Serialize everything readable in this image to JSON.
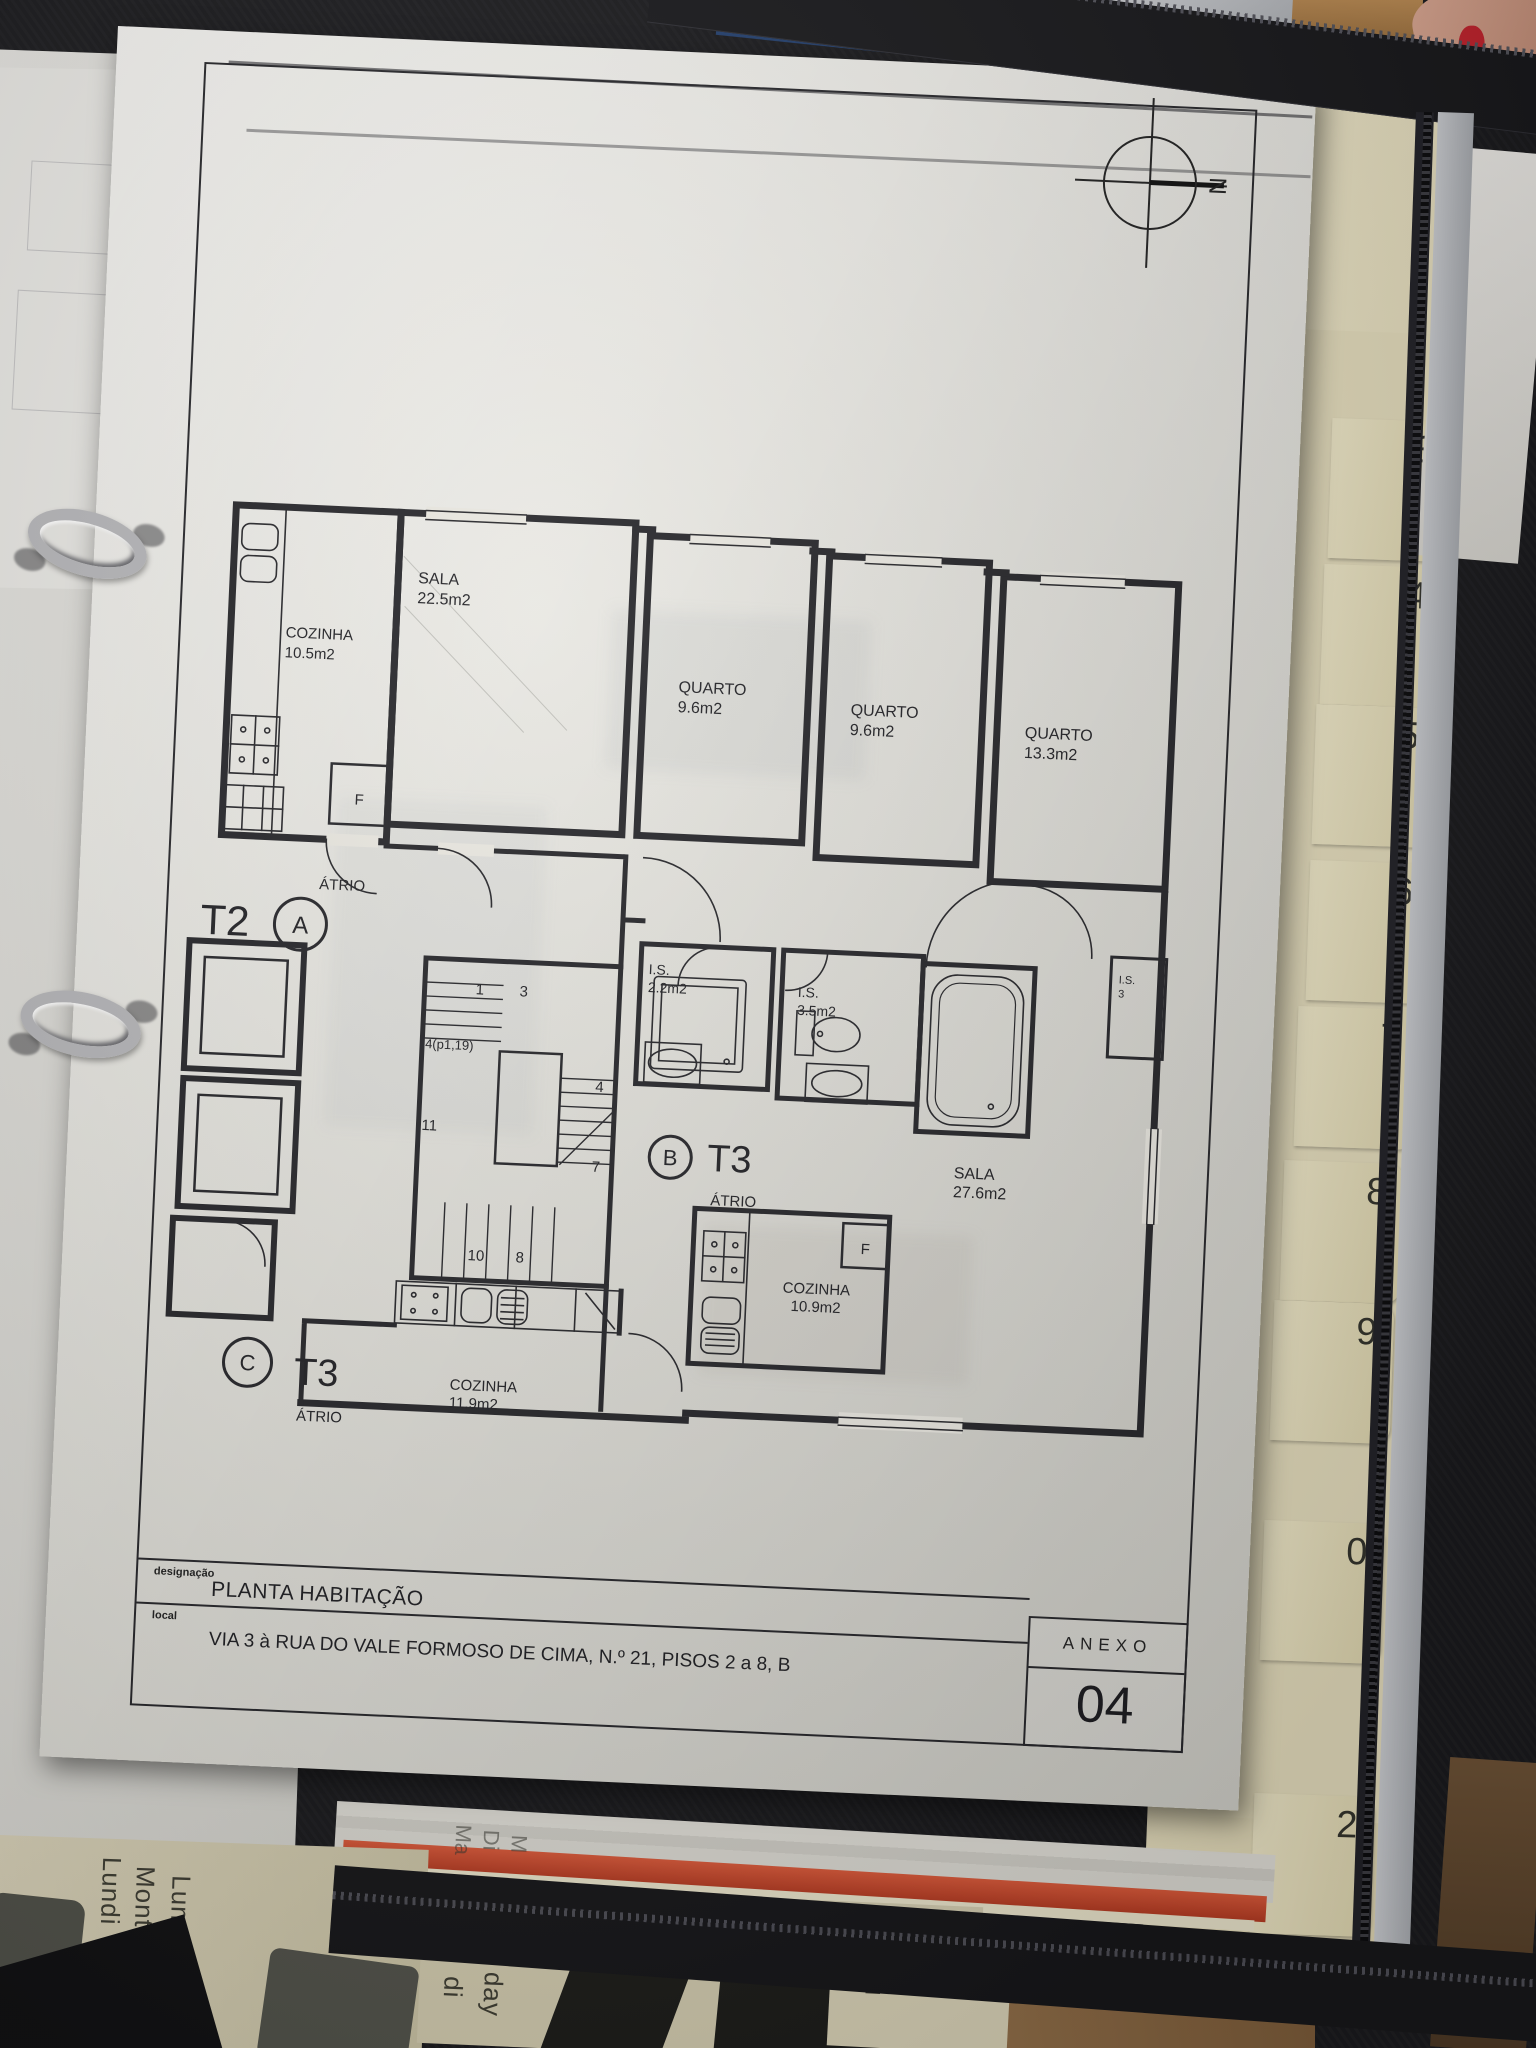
{
  "photo": {
    "tabs": [
      "3",
      "4",
      "5",
      "6",
      "7",
      "8",
      "9",
      "0",
      "2"
    ],
    "books": {
      "left": [
        "Lundi",
        "Montag",
        "Lunes"
      ],
      "mid_top": [
        "Ma",
        "Di",
        "M"
      ],
      "mid_bottom": [
        "di",
        "day"
      ],
      "right": [
        "rcoled",
        "dnes"
      ]
    }
  },
  "sheet": {
    "compass": {
      "north": "N"
    },
    "plan": {
      "f": "F",
      "rooms": {
        "sala_t2": {
          "name": "SALA",
          "area": "22.5m2"
        },
        "quarto_1": {
          "name": "QUARTO",
          "area": "9.6m2"
        },
        "quarto_2": {
          "name": "QUARTO",
          "area": "9.6m2"
        },
        "quarto_3": {
          "name": "QUARTO",
          "area": "13.3m2"
        },
        "cozinha_t2": {
          "name": "COZINHA",
          "area": "10.5m2"
        },
        "is_1": {
          "name": "I.S.",
          "area": "2.2m2"
        },
        "is_2": {
          "name": "I.S.",
          "area": "3.5m2"
        },
        "is_small": {
          "name": "I.S.",
          "area": "3"
        },
        "sala_t3": {
          "name": "SALA",
          "area": "27.6m2"
        },
        "cozinha_t3b": {
          "name": "COZINHA",
          "area": "10.9m2"
        },
        "cozinha_t3c": {
          "name": "COZINHA",
          "area": "11.9m2"
        }
      },
      "units": {
        "t2": "T2",
        "a": "A",
        "atrio_a": "ÁTRIO",
        "b": "B",
        "t3_b": "T3",
        "atrio_b": "ÁTRIO",
        "c": "C",
        "t3_c": "T3",
        "atrio_c": "ÁTRIO"
      },
      "stairs": {
        "s1": "1",
        "s3": "3",
        "s4p": "4(p1,19)",
        "s4": "4",
        "s11": "11",
        "s7": "7",
        "s10": "10",
        "s8": "8"
      }
    },
    "title_block": {
      "designacao_label": "designação",
      "designacao": "PLANTA HABITAÇÃO",
      "local_label": "local",
      "local": "VIA 3 à RUA DO VALE FORMOSO DE CIMA, N.º 21, PISOS 2 a 8, B",
      "anexo_label": "ANEXO",
      "anexo_number": "04"
    }
  }
}
